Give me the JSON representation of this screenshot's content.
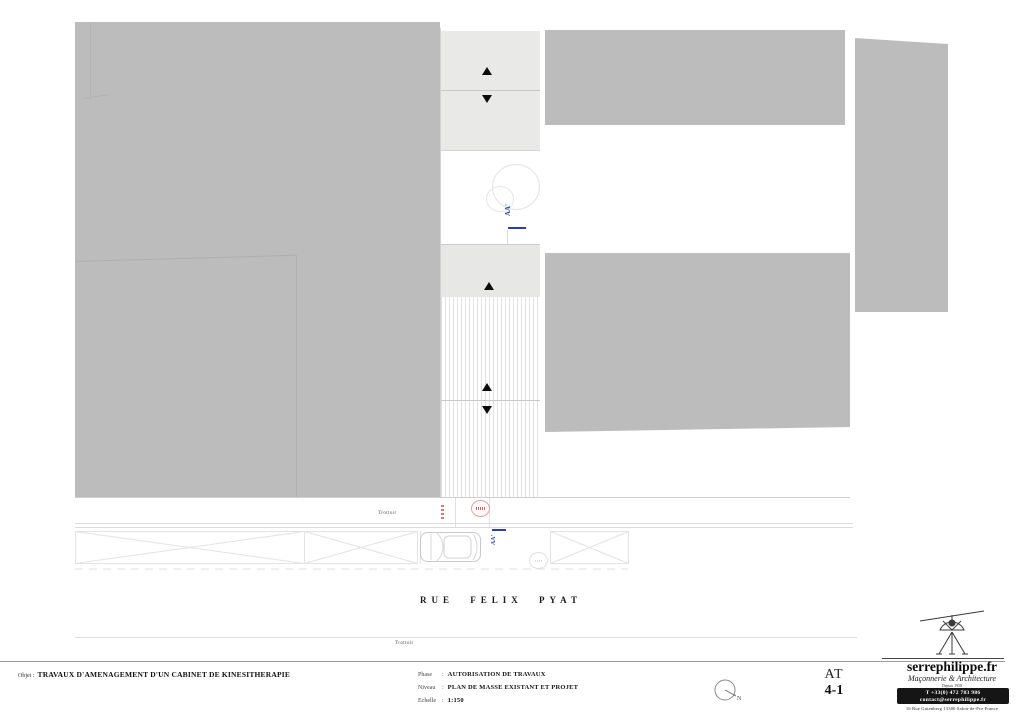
{
  "sheet": {
    "objet_label": "Objet :",
    "objet_value": "TRAVAUX D'AMENAGEMENT D'UN CABINET DE KINESITHERAPIE",
    "phase_label": "Phase",
    "phase_colon": ":",
    "phase_value": "AUTORISATION DE TRAVAUX",
    "niveau_label": "Niveau",
    "niveau_colon": ":",
    "niveau_value": "PLAN DE MASSE EXISTANT ET PROJET",
    "echelle_label": "Echelle",
    "echelle_colon": ":",
    "echelle_value": "1:150",
    "sheet_code": "AT",
    "sheet_number": "4-1",
    "north_label": "N"
  },
  "plan": {
    "street_name": "RUE FELIX PYAT",
    "sidewalk_top_label": "Trottoir",
    "sidewalk_bottom_label": "Trottoir",
    "section_marker_top": "AA'",
    "section_marker_bottom": "AA'"
  },
  "branding": {
    "website": "serrephilippe.fr",
    "tagline": "Maçonnerie & Architecture",
    "since": "Depuis 1958",
    "phone": "T +33(0) 472 783 986",
    "email": "contact@serrephilippe.fr",
    "address": "16 Rue Gutenberg 13300 Salon-de-Pce France"
  },
  "colors": {
    "building_gray": "#bcbcbc",
    "panel_gray": "#e9e9e8",
    "section_blue": "#2e3fa3",
    "annotation_red": "#d05050"
  }
}
